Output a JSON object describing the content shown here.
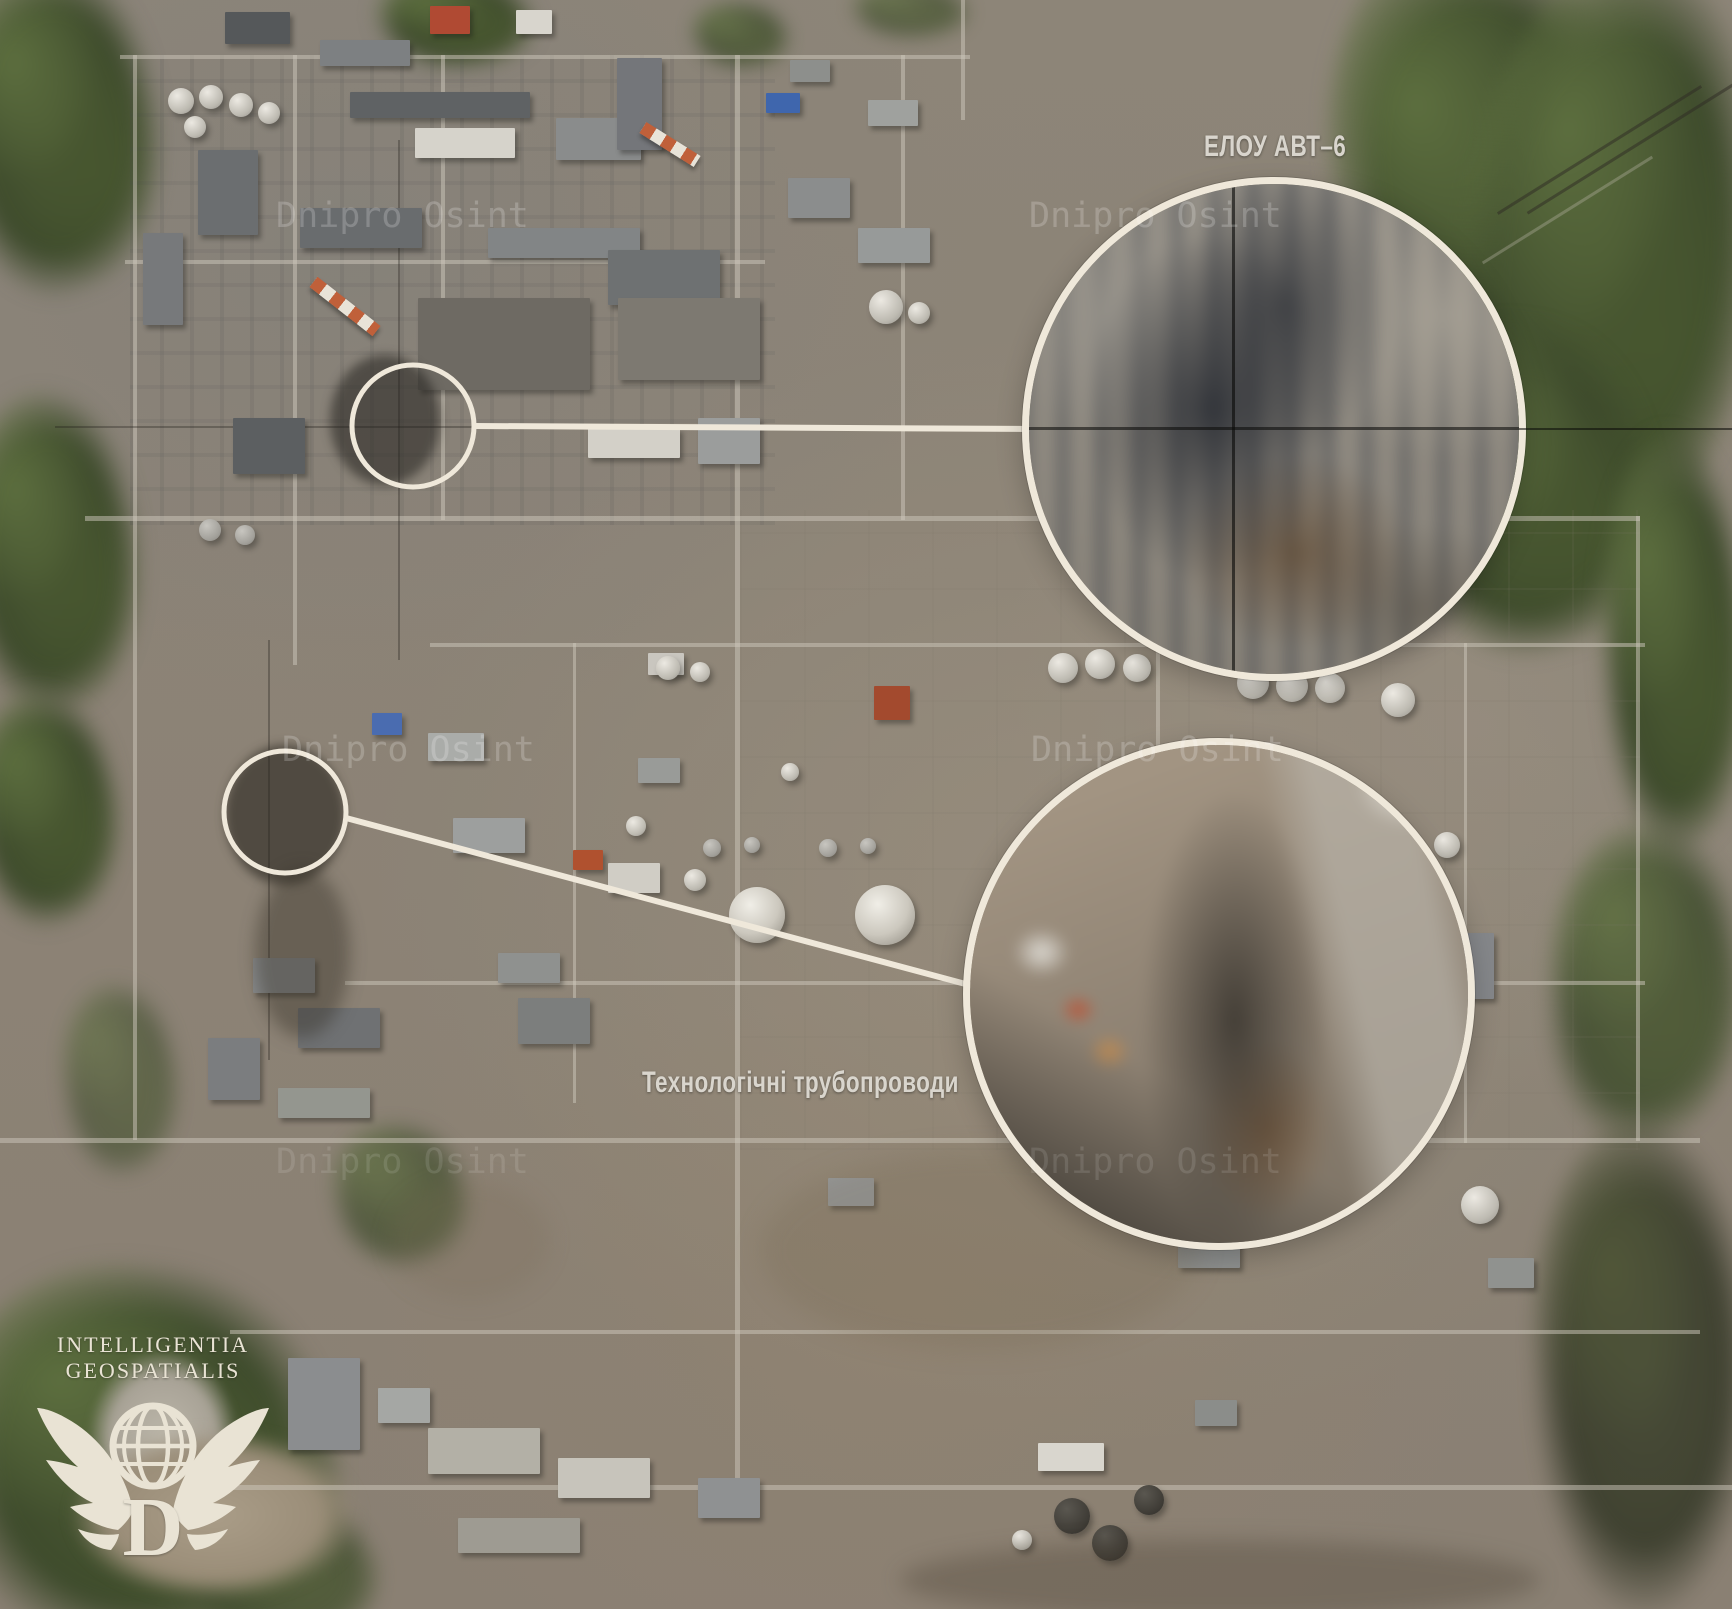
{
  "page": {
    "type": "annotated satellite image",
    "subject": "oil refinery aerial view with OSINT damage callouts"
  },
  "callouts": [
    {
      "id": "inset-1",
      "label": "ЕЛОУ АВТ–6"
    },
    {
      "id": "inset-2",
      "label": "Технологічні трубопроводи"
    }
  ],
  "watermark": {
    "text": "Dnipro Osint"
  },
  "logo": {
    "line1": "INTELLIGENTIA",
    "line2": "GEOSPATIALIS",
    "monogram": "D"
  },
  "colors": {
    "annotation_cream": "#EFE8DA",
    "label_text": "#D9D5CD",
    "watermark_white": "#FFFFFF",
    "logo_cream": "#E9E3D4",
    "vegetation_green": "#4E5D35",
    "ground_tan": "#9A9082"
  }
}
